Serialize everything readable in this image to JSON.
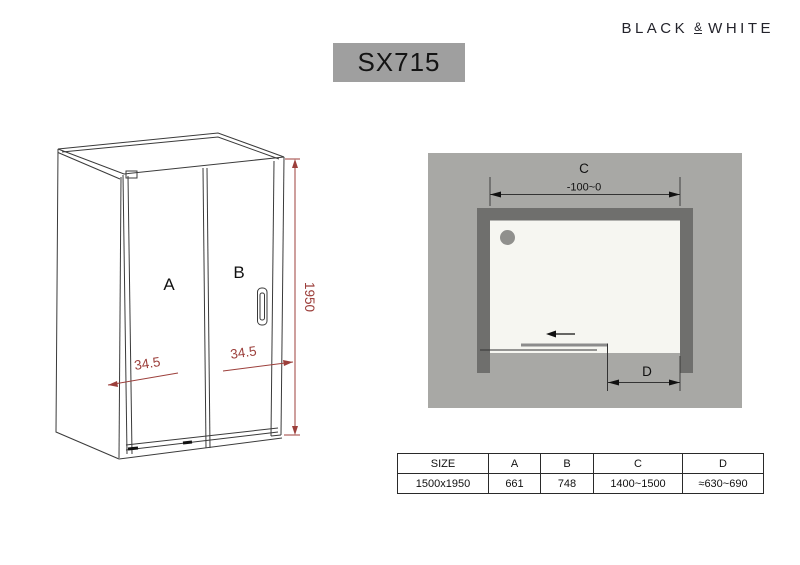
{
  "brand": {
    "word1": "BLACK",
    "amp": "&",
    "word2": "WHITE"
  },
  "model": "SX715",
  "front_view": {
    "panel_a_label": "A",
    "panel_b_label": "B",
    "dim_left": "34.5",
    "dim_right": "34.5",
    "dim_height": "1950",
    "dim_color": "#9c3f3b",
    "line_color": "#3a3a3a"
  },
  "top_view": {
    "dim_c_label": "C",
    "dim_c_value": "-100~0",
    "dim_d_label": "D",
    "colors": {
      "background": "#a8a8a5",
      "wall": "#6f6f6d",
      "tray": "#f6f6f1",
      "drain": "#90908d",
      "door": "#8c8c8c"
    }
  },
  "table": {
    "headers": [
      "SIZE",
      "A",
      "B",
      "C",
      "D"
    ],
    "rows": [
      [
        "1500x1950",
        "661",
        "748",
        "1400~1500",
        "≈630~690"
      ]
    ]
  }
}
